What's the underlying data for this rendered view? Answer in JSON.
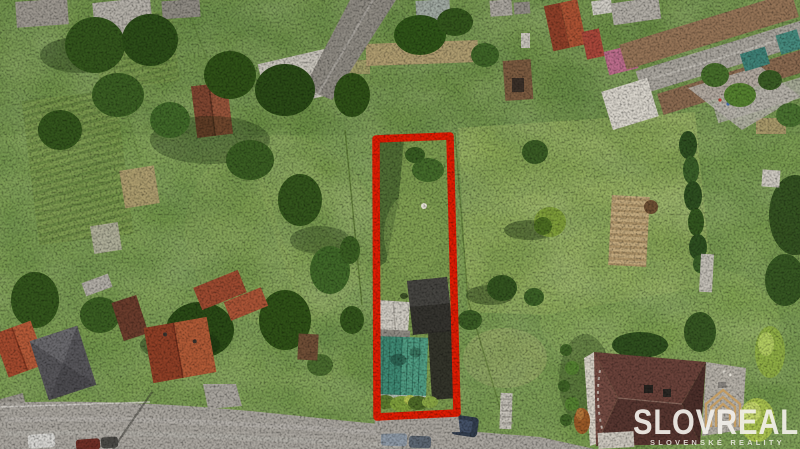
{
  "image": {
    "kind": "aerial-drone-photo",
    "subject": "real-estate land plot highlighted with red boundary in a village",
    "width_px": 800,
    "height_px": 449
  },
  "watermark": {
    "brand": "SLOVREAL",
    "tagline": "SLOVENSKÉ REALITY",
    "text_color": "#f3f0ea",
    "logo_gold": "#c49c60",
    "logo_icon": "nested-house-outline-icon"
  },
  "plot_boundary": {
    "color": "#df1c03",
    "stroke_width_px": 7,
    "shape": "long narrow quadrilateral, centered, from mid-top to road at bottom"
  },
  "scene": {
    "highlighted_plot_contents": [
      "lawn with tree shadows",
      "small white object on grass",
      "farm outbuildings",
      "teal metal roof",
      "dark barn roofs",
      "white roof shed"
    ],
    "surroundings": [
      "garden allotments with tilled beds (left)",
      "village houses with grey, red, brown and pink roofs (top)",
      "industrial yard with rusty long roofs (top right)",
      "bright green meadow with trees (right)",
      "large maroon-roof family house with garden (bottom right)",
      "asphalt road with parked cars (bottom)"
    ],
    "cars_visible": 6,
    "hedge": "dark green hedge line on right side",
    "sun_direction": "shadows fall to the lower-left"
  },
  "colors": {
    "grass_base": "#75984a",
    "meadow_bright": "#9db45f",
    "tree_dark": "#2f5117",
    "road_grey": "#a9a59e",
    "teal_roof": "#3f8a74",
    "maroon_roof": "#5f3b33",
    "orange_tile_roof": "#b05a36",
    "dirt_tan": "#b59d73"
  }
}
